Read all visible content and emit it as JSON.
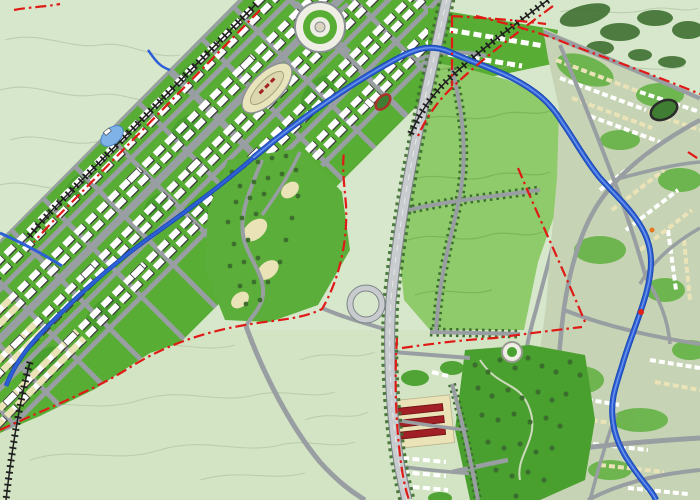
{
  "meta": {
    "kind": "urban-master-plan-map",
    "description": "Colored master plan rendering: a diagonal new-town grid band with canal, circular plaza and racecourse; central park; vertical bypass highway with interchange; railways; winding river through the dense existing city on the right; red dash-dot planning boundary lines over pale contoured terrain.",
    "canvas": {
      "width": 700,
      "height": 500
    }
  },
  "colors": {
    "terrain": "#d7e7cc",
    "terrain_south_tint": "#cfe0bd",
    "terrain_contour": "#b4cba7",
    "forest": "#3c6e2d",
    "parkland_bright": "#58ad34",
    "parkland_deep": "#49a02e",
    "parkland_medium": "#8fca6b",
    "park_texture": "#7ab457",
    "hill_green": "#5cae3a",
    "city_base": "#c6d3b4",
    "city_green": "#64b244",
    "road_fill": "#c9ccce",
    "road_casing": "#7e8488",
    "road_line": "#989ea1",
    "water": "#2d5fd6",
    "water_dark": "#1c4ab2",
    "water_light": "#6d95ea",
    "pond": "#7fb3e8",
    "railway": "#1f1f1f",
    "boundary": "#e01a16",
    "building_white": "#ffffff",
    "building_outline": "#3f3f3f",
    "building_cream": "#ebe3b8",
    "building_red": "#a02025",
    "plaza_surface": "#efeee4",
    "track_surface": "#e8e4bc",
    "stadium_field": "#3f7d33",
    "stadium_track": "#a83228",
    "marker_red": "#e02built",
    "marker_orange": "#e87820"
  },
  "features": [
    {
      "id": "new-town-band",
      "label": "new town development grid (diagonal band)"
    },
    {
      "id": "canal",
      "label": "landscape canal along band spine"
    },
    {
      "id": "circular-plaza",
      "label": "circular civic plaza"
    },
    {
      "id": "racecourse-oval",
      "label": "racecourse / sports oval"
    },
    {
      "id": "athletics-stadium",
      "label": "small stadium with red track"
    },
    {
      "id": "hillside-zone",
      "label": "hillside low-density zone with trees"
    },
    {
      "id": "central-park",
      "label": "central park with tree-lined drives"
    },
    {
      "id": "existing-city",
      "label": "existing dense city fabric"
    },
    {
      "id": "river",
      "label": "river winding through city"
    },
    {
      "id": "highway-bypass",
      "label": "north-south bypass highway"
    },
    {
      "id": "highway-interchange",
      "label": "loop ramp interchange"
    },
    {
      "id": "railway-line",
      "label": "railway with tie hatching"
    },
    {
      "id": "planning-boundary",
      "label": "red dash-dot planning boundary"
    },
    {
      "id": "south-district",
      "label": "southern residential district"
    },
    {
      "id": "industrial-rows",
      "label": "dark red building rows"
    },
    {
      "id": "city-park-south",
      "label": "wooded city park with paths"
    },
    {
      "id": "terrain-contours",
      "label": "contour-lined open terrain"
    }
  ]
}
